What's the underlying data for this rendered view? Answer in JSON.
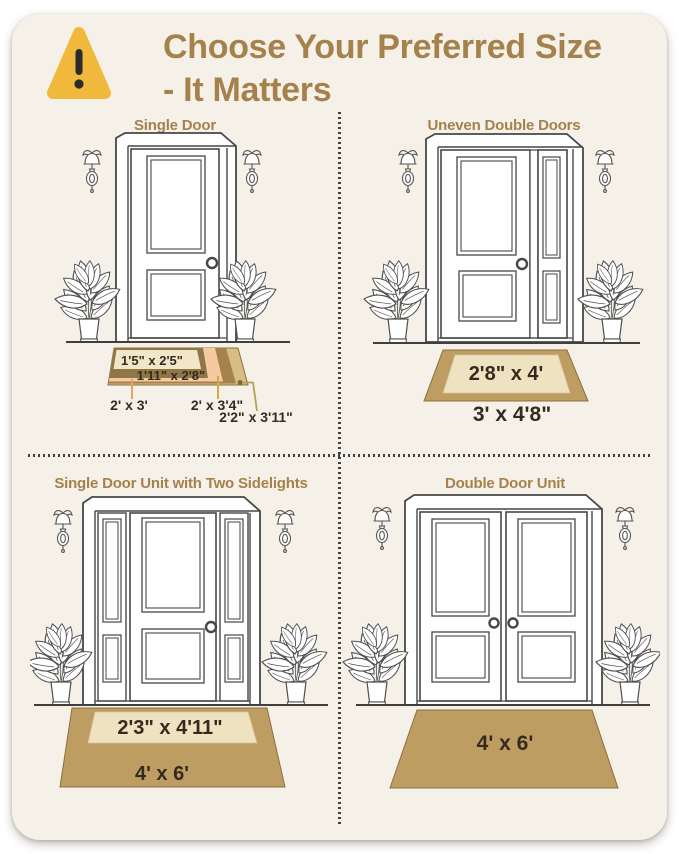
{
  "header": {
    "title_line1": "Choose Your Preferred Size",
    "title_line2": "- It Matters"
  },
  "quadrants": [
    {
      "title": "Single Door",
      "sizes": [
        "1'5\" x 2'5\"",
        "1'11\" x 2'8\"",
        "2' x 3'",
        "2' x 3'4\"",
        "2'2\" x 3'11\""
      ]
    },
    {
      "title": "Uneven Double Doors",
      "sizes": [
        "2'8\" x 4'",
        "3' x 4'8\""
      ]
    },
    {
      "title": "Single Door Unit with Two Sidelights",
      "sizes": [
        "2'3\" x 4'11\"",
        "4' x 6'"
      ]
    },
    {
      "title": "Double Door Unit",
      "sizes": [
        "4' x 6'"
      ]
    }
  ],
  "icons": {
    "warning": "warning-triangle-icon",
    "sconce": "wall-sconce-icon",
    "plant": "potted-plant-icon"
  },
  "colors": {
    "accent_gold": "#a5824c",
    "panel_background": "#f6f1e8",
    "warning_yellow": "#f0b93b",
    "warning_mark": "#2b2b2b",
    "mat_tan": "#bd9d62",
    "mat_cream": "#efe2c0",
    "mat_layer_tan_light": "#d7bc84",
    "mat_layer_brown": "#a5824d",
    "mat_layer_peach": "#f6caa0",
    "mat_layer_olive": "#8f7647",
    "mat_layer_cream": "#f2e6c8",
    "label_text": "#342b1e",
    "line_art": "#474747",
    "leader_orange": "#ef9e63",
    "leader_gold": "#d7a945",
    "leader_olive": "#b1a15a"
  }
}
